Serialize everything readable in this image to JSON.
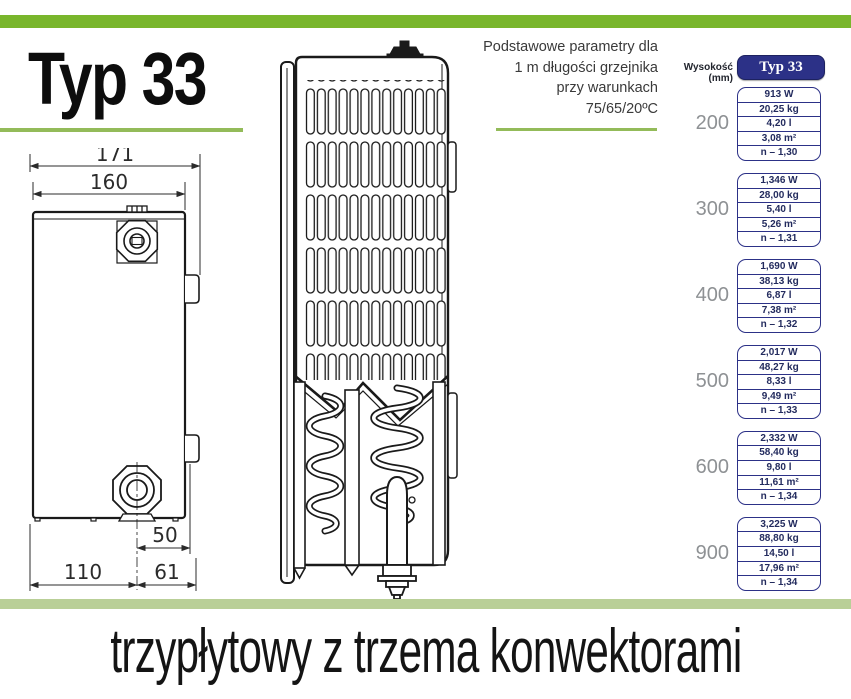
{
  "page": {
    "title_heading": "Typ 33",
    "bottom_caption": "trzypłytowy z trzema konwektorami",
    "params_note": {
      "line1": "Podstawowe parametry dla",
      "line2": "1 m długości grzejnika",
      "line3": "przy warunkach",
      "line4": "75/65/20ºC"
    }
  },
  "diagram": {
    "side_view": {
      "dim_width_total": "171",
      "dim_width_body": "160",
      "dim_valve_offset": "50",
      "dim_bottom_left": "110",
      "dim_bottom_right": "61"
    }
  },
  "table": {
    "height_label": "Wysokość (mm)",
    "header": "Typ 33",
    "groups": [
      {
        "height": "200",
        "rows": [
          "913 W",
          "20,25 kg",
          "4,20 l",
          "3,08 m²",
          "n – 1,30"
        ]
      },
      {
        "height": "300",
        "rows": [
          "1,346 W",
          "28,00 kg",
          "5,40 l",
          "5,26 m²",
          "n – 1,31"
        ]
      },
      {
        "height": "400",
        "rows": [
          "1,690 W",
          "38,13 kg",
          "6,87 l",
          "7,38 m²",
          "n – 1,32"
        ]
      },
      {
        "height": "500",
        "rows": [
          "2,017 W",
          "48,27 kg",
          "8,33 l",
          "9,49 m²",
          "n – 1,33"
        ]
      },
      {
        "height": "600",
        "rows": [
          "2,332 W",
          "58,40 kg",
          "9,80 l",
          "11,61 m²",
          "n – 1,34"
        ]
      },
      {
        "height": "900",
        "rows": [
          "3,225 W",
          "88,80 kg",
          "14,50 l",
          "17,96 m²",
          "n – 1,34"
        ]
      }
    ]
  },
  "colors": {
    "accent_green": "#79b62c",
    "rule_green": "#93bb59",
    "pale_green_bar": "#b9cf97",
    "navy": "#2c3187",
    "table_text_navy": "#232b5e",
    "height_label_gray": "#8e9194",
    "line_art": "#1a1a1a"
  }
}
